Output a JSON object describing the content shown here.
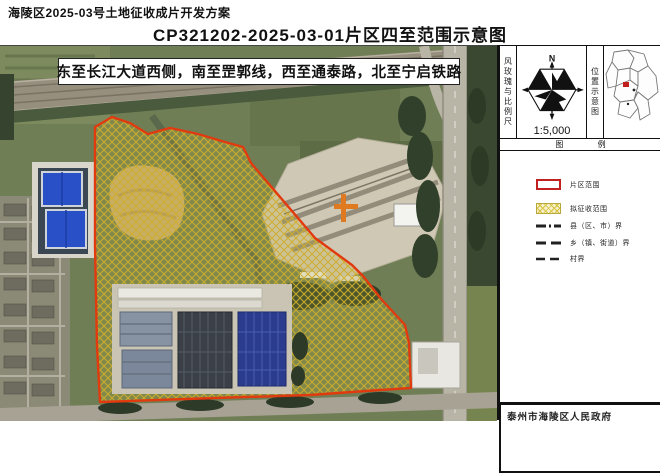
{
  "header": {
    "doc_title": "海陵区2025-03号土地征收成片开发方案",
    "map_title": "CP321202-2025-03-01片区四至范围示意图"
  },
  "map": {
    "boundary_note": "东至长江大道西侧，南至罡郭线，西至通泰路，北至宁启铁路"
  },
  "sidebar": {
    "windrose_panel": {
      "label_vertical": "风玫瑰与比例尺",
      "north_label": "N",
      "scale_text": "1:5,000"
    },
    "location_panel": {
      "label_vertical": "位置示意图"
    },
    "legend": {
      "header": "图 例",
      "items": [
        {
          "symbol": "red-rect",
          "label": "片区范围"
        },
        {
          "symbol": "yellow-hatch",
          "label": "拟征收范围"
        },
        {
          "symbol": "dash-dot",
          "label": "县（区、市）界"
        },
        {
          "symbol": "long-dash",
          "label": "乡（镇、街道）界"
        },
        {
          "symbol": "short-dash",
          "label": "村界"
        }
      ]
    },
    "footer": "泰州市海陵区人民政府"
  },
  "colors": {
    "parcel_boundary_red": "#e23a0f",
    "expropriation_hatch_yellow": "#cfae2c",
    "pond_blue": "#2a50c8",
    "factory_navy": "#2b3c8e"
  }
}
